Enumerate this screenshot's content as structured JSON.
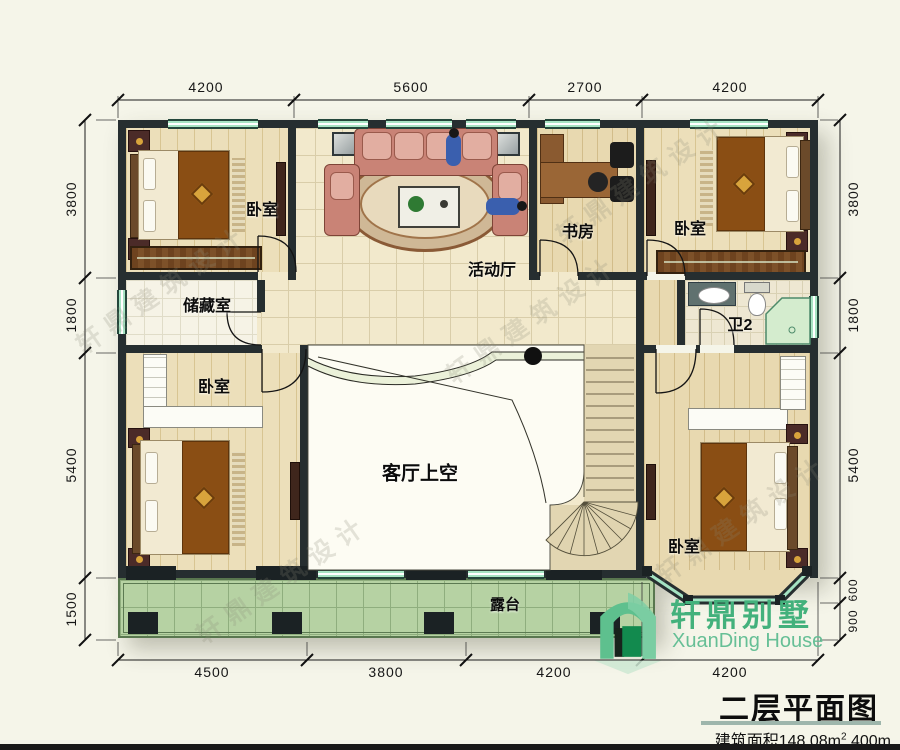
{
  "watermark": "轩鼎建筑设计",
  "logo": {
    "name_cn": "轩鼎别墅",
    "name_en": "XuanDing House"
  },
  "title_block": {
    "title": "二层平面图",
    "area_prefix": "建筑面积148.08m",
    "area_sup": "2",
    "area_suffix": " 400m"
  },
  "rooms": {
    "bedroom_tl": "卧室",
    "bedroom_tr": "卧室",
    "bedroom_bl": "卧室",
    "bedroom_br": "卧室",
    "storage": "储藏室",
    "activity_hall": "活动厅",
    "study": "书房",
    "bath2": "卫2",
    "living_void": "客厅上空",
    "terrace": "露台"
  },
  "dimensions": {
    "top": [
      "4200",
      "5600",
      "2700",
      "4200"
    ],
    "bottom": [
      "4500",
      "3800",
      "4200",
      "4200"
    ],
    "left": [
      "3800",
      "1800",
      "5400",
      "1500"
    ],
    "right": [
      "3800",
      "1800",
      "5400",
      "600",
      "900"
    ]
  }
}
